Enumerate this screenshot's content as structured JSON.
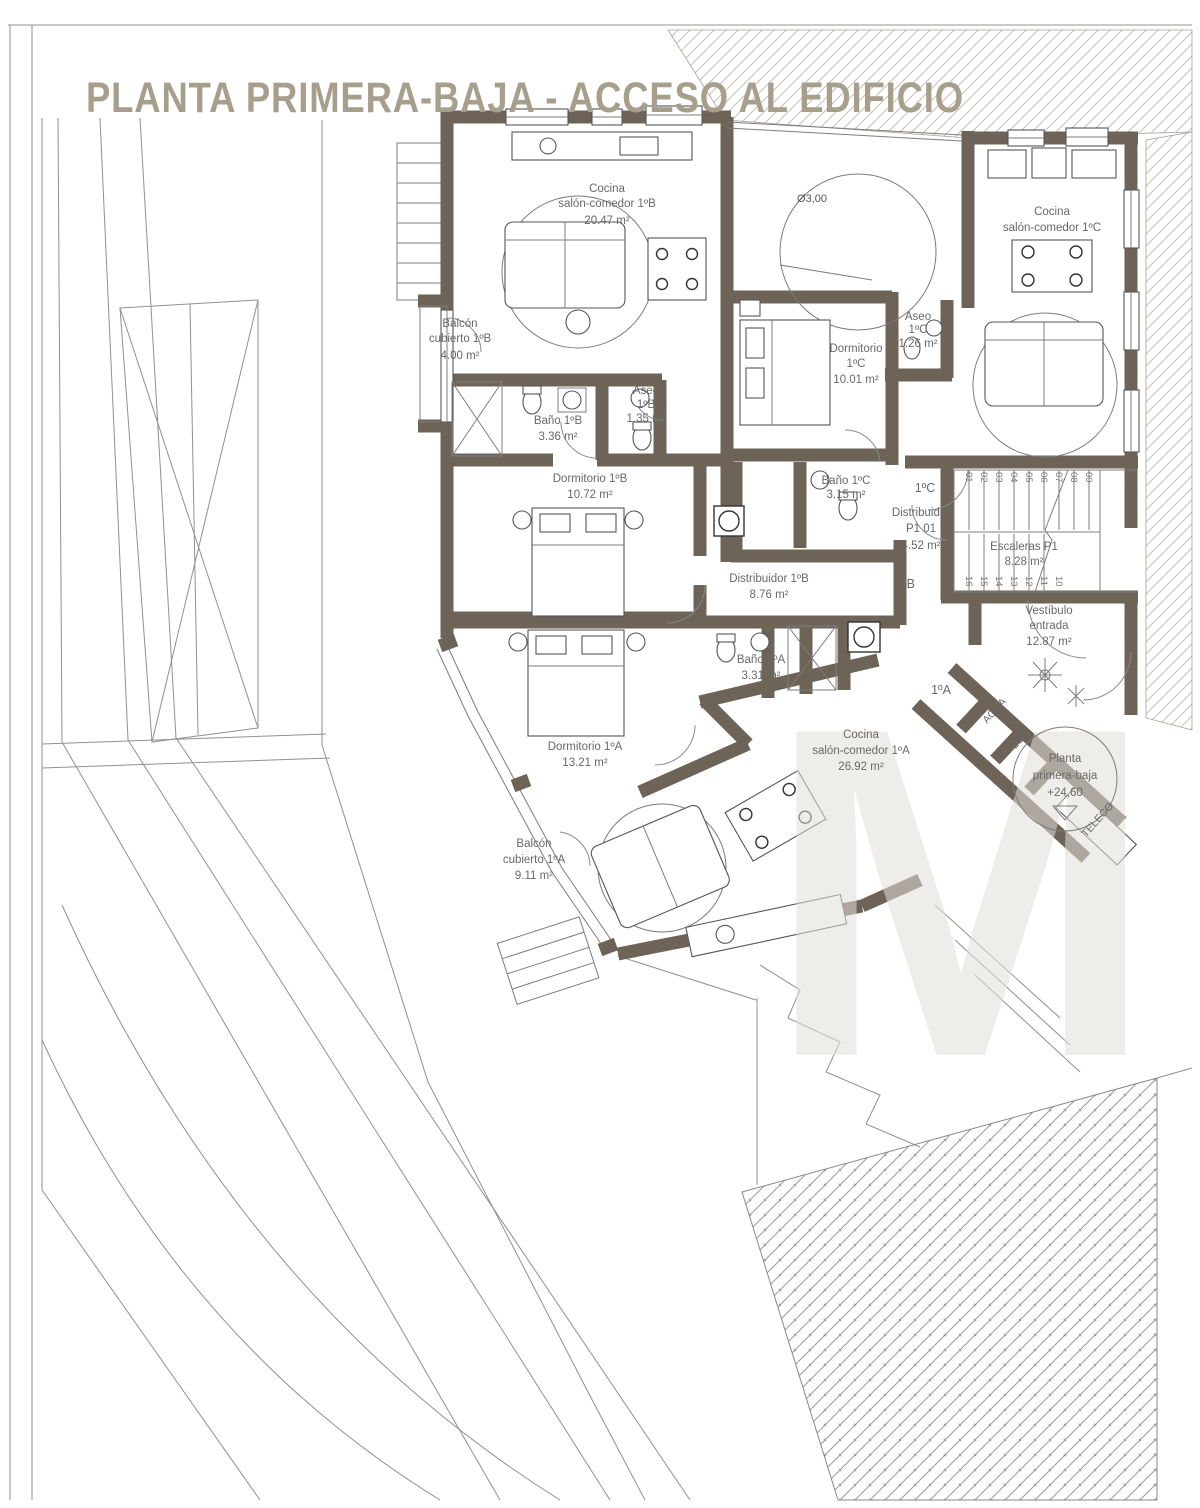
{
  "title": "PLANTA PRIMERA-BAJA - ACCESO AL EDIFICIO",
  "watermark": "M",
  "colors": {
    "wall": "#6d6357",
    "title": "#a79e8c",
    "label": "#686868",
    "site_line": "#909090",
    "hatch": "#c6c0b4"
  },
  "rooms": [
    {
      "id": "cocina-salon-1b",
      "lines": [
        "Cocina",
        "salón-comedor 1ºB",
        "20.47 m²"
      ]
    },
    {
      "id": "balcon-cubierto-1b",
      "lines": [
        "Balcón",
        "cubierto 1ºB",
        "4.00 m²"
      ]
    },
    {
      "id": "bano-1b",
      "lines": [
        "Baño 1ºB",
        "3.36 m²"
      ]
    },
    {
      "id": "aseo-1b",
      "lines": [
        "Aseo",
        "1ºB",
        "1.35 m²"
      ]
    },
    {
      "id": "dormitorio-1b",
      "lines": [
        "Dormitorio 1ºB",
        "10.72 m²"
      ]
    },
    {
      "id": "dormitorio-1c",
      "lines": [
        "Dormitorio",
        "1ºC",
        "10.01 m²"
      ]
    },
    {
      "id": "aseo-1c",
      "lines": [
        "Aseo",
        "1ºC",
        "1.26 m²"
      ]
    },
    {
      "id": "cocina-salon-1c",
      "lines": [
        "Cocina",
        "salón-comedor 1ºC"
      ]
    },
    {
      "id": "bano-1c",
      "lines": [
        "Baño 1ºC",
        "3.15 m²"
      ]
    },
    {
      "id": "distribuidor-p1",
      "lines": [
        "Distribuidor",
        "P1 01",
        "4.52 m²"
      ]
    },
    {
      "id": "escaleras-p1",
      "lines": [
        "Escaleras P1",
        "8.28 m²"
      ]
    },
    {
      "id": "distribuidor-1b",
      "lines": [
        "Distribuidor 1ºB",
        "8.76 m²"
      ]
    },
    {
      "id": "vestibulo-entrada",
      "lines": [
        "Vestíbulo",
        "entrada",
        "12.87 m²"
      ]
    },
    {
      "id": "bano-1a",
      "lines": [
        "Baño 1ºA",
        "3.31 m²"
      ]
    },
    {
      "id": "cocina-salon-1a",
      "lines": [
        "Cocina",
        "salón-comedor 1ºA",
        "26.92 m²"
      ]
    },
    {
      "id": "dormitorio-1a",
      "lines": [
        "Dormitorio 1ºA",
        "13.21 m²"
      ]
    },
    {
      "id": "balcon-cubierto-1a",
      "lines": [
        "Balcón",
        "cubierto 1ºA",
        "9.11 m²"
      ]
    }
  ],
  "unit_tags": [
    "1ºC",
    "1ºB",
    "1ºA"
  ],
  "annotations": {
    "patio_diameter": "Ø3,00",
    "level_marker": [
      "Planta",
      "primera-baja",
      "+24,60"
    ],
    "utilities": [
      "AGUA",
      "LUZ",
      "TELECO"
    ]
  },
  "stairs": {
    "up_numbers": [
      "01",
      "02",
      "03",
      "04",
      "05",
      "06",
      "07",
      "08",
      "09"
    ],
    "down_numbers": [
      "16",
      "15",
      "14",
      "13",
      "12",
      "11",
      "10"
    ]
  }
}
